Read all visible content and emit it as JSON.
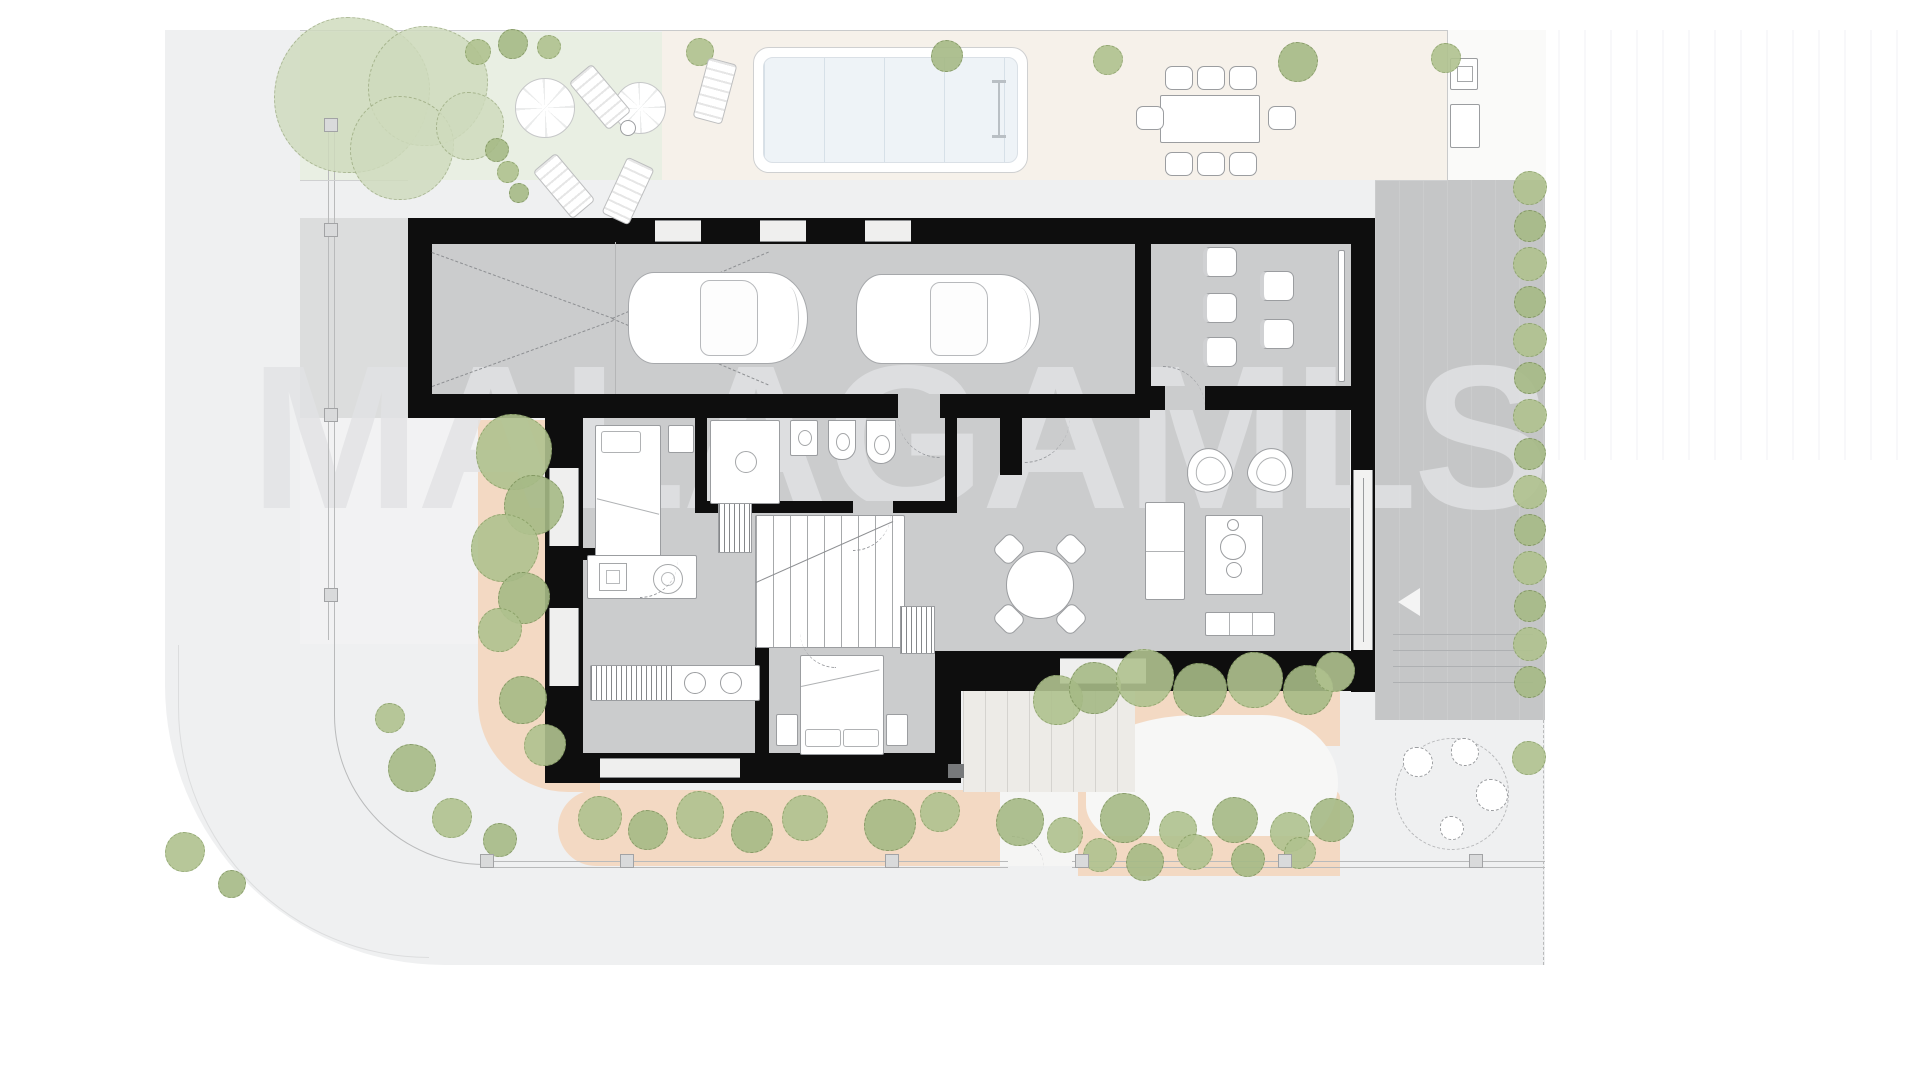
{
  "watermark": {
    "text": "MALAGAMLS"
  },
  "palette": {
    "background": "#ffffff",
    "street": "#eff0f1",
    "garden_green": "#e9efe3",
    "terrace_beige": "#f6f1ea",
    "planting_bed_orange": "#f3d9c3",
    "building_floor": "#cbcccd",
    "driveway": "#c5c6c7",
    "wall_black": "#0e0e0e",
    "tree_green": "#b0c28f",
    "pool_water": "#eef3f7",
    "watermark_gray": "#e2e3e5"
  },
  "scene": {
    "trees_big": [
      {
        "x": 352,
        "y": 95,
        "r": 78
      },
      {
        "x": 428,
        "y": 86,
        "r": 60
      },
      {
        "x": 402,
        "y": 148,
        "r": 52
      },
      {
        "x": 470,
        "y": 126,
        "r": 34
      }
    ],
    "tree_groups": {
      "top_bushes": [
        {
          "x": 478,
          "y": 52,
          "r": 13
        },
        {
          "x": 513,
          "y": 44,
          "r": 15
        },
        {
          "x": 549,
          "y": 47,
          "r": 12
        },
        {
          "x": 497,
          "y": 150,
          "r": 12
        },
        {
          "x": 508,
          "y": 172,
          "r": 11
        },
        {
          "x": 519,
          "y": 193,
          "r": 10
        }
      ],
      "terrace_trees": [
        {
          "x": 700,
          "y": 52,
          "r": 14
        },
        {
          "x": 947,
          "y": 56,
          "r": 16
        },
        {
          "x": 1108,
          "y": 60,
          "r": 15
        },
        {
          "x": 1298,
          "y": 62,
          "r": 20
        },
        {
          "x": 1446,
          "y": 58,
          "r": 15
        }
      ],
      "left_bed": [
        {
          "x": 514,
          "y": 452,
          "r": 38
        },
        {
          "x": 534,
          "y": 505,
          "r": 30
        },
        {
          "x": 505,
          "y": 548,
          "r": 34
        },
        {
          "x": 524,
          "y": 598,
          "r": 26
        },
        {
          "x": 500,
          "y": 630,
          "r": 22
        },
        {
          "x": 523,
          "y": 700,
          "r": 24
        },
        {
          "x": 545,
          "y": 745,
          "r": 21
        }
      ],
      "bottom_bed": [
        {
          "x": 600,
          "y": 818,
          "r": 22
        },
        {
          "x": 648,
          "y": 830,
          "r": 20
        },
        {
          "x": 700,
          "y": 815,
          "r": 24
        },
        {
          "x": 752,
          "y": 832,
          "r": 21
        },
        {
          "x": 805,
          "y": 818,
          "r": 23
        },
        {
          "x": 890,
          "y": 825,
          "r": 26
        },
        {
          "x": 940,
          "y": 812,
          "r": 20
        },
        {
          "x": 1020,
          "y": 822,
          "r": 24
        },
        {
          "x": 1065,
          "y": 835,
          "r": 18
        },
        {
          "x": 1125,
          "y": 818,
          "r": 25
        },
        {
          "x": 1178,
          "y": 830,
          "r": 19
        },
        {
          "x": 1235,
          "y": 820,
          "r": 23
        },
        {
          "x": 1290,
          "y": 832,
          "r": 20
        },
        {
          "x": 1332,
          "y": 820,
          "r": 22
        }
      ],
      "bottom_left_scatter": [
        {
          "x": 390,
          "y": 718,
          "r": 15
        },
        {
          "x": 412,
          "y": 768,
          "r": 24
        },
        {
          "x": 452,
          "y": 818,
          "r": 20
        },
        {
          "x": 500,
          "y": 840,
          "r": 17
        },
        {
          "x": 185,
          "y": 852,
          "r": 20
        },
        {
          "x": 232,
          "y": 884,
          "r": 14
        }
      ],
      "garden_right_upper": [
        {
          "x": 1058,
          "y": 700,
          "r": 25
        },
        {
          "x": 1095,
          "y": 688,
          "r": 26
        },
        {
          "x": 1145,
          "y": 678,
          "r": 29
        },
        {
          "x": 1200,
          "y": 690,
          "r": 27
        },
        {
          "x": 1255,
          "y": 680,
          "r": 28
        },
        {
          "x": 1308,
          "y": 690,
          "r": 25
        },
        {
          "x": 1335,
          "y": 672,
          "r": 20
        }
      ],
      "garden_right_lower": [
        {
          "x": 1100,
          "y": 855,
          "r": 17
        },
        {
          "x": 1145,
          "y": 862,
          "r": 19
        },
        {
          "x": 1195,
          "y": 852,
          "r": 18
        },
        {
          "x": 1248,
          "y": 860,
          "r": 17
        },
        {
          "x": 1300,
          "y": 853,
          "r": 16
        }
      ],
      "misc_right": [
        {
          "x": 1529,
          "y": 758,
          "r": 17
        }
      ]
    },
    "hedge_right": {
      "x": 1530,
      "y_start": 188,
      "step": 38,
      "count": 14,
      "r": 17
    },
    "fence_posts_left": {
      "x": 331,
      "ys": [
        125,
        230,
        415,
        595
      ]
    },
    "fence_posts_bottom": {
      "y": 861,
      "xs": [
        487,
        627,
        892,
        1082,
        1285,
        1476
      ]
    },
    "office_chairs": [
      {
        "x": 1203,
        "y": 247
      },
      {
        "x": 1203,
        "y": 293
      },
      {
        "x": 1203,
        "y": 337
      },
      {
        "x": 1260,
        "y": 271
      },
      {
        "x": 1260,
        "y": 319
      }
    ],
    "dining_chairs": [
      {
        "x": 1165,
        "y": 66
      },
      {
        "x": 1197,
        "y": 66
      },
      {
        "x": 1229,
        "y": 66
      },
      {
        "x": 1165,
        "y": 152
      },
      {
        "x": 1197,
        "y": 152
      },
      {
        "x": 1229,
        "y": 152
      },
      {
        "x": 1136,
        "y": 106
      },
      {
        "x": 1268,
        "y": 106
      }
    ],
    "loungers": [
      {
        "x": 585,
        "y": 66,
        "rot": -40
      },
      {
        "x": 549,
        "y": 155,
        "rot": -40
      },
      {
        "x": 613,
        "y": 160,
        "rot": 25
      },
      {
        "x": 700,
        "y": 60,
        "rot": 15
      }
    ],
    "seating_chairs": [
      {
        "x": 1418,
        "y": 762,
        "r": 15
      },
      {
        "x": 1465,
        "y": 752,
        "r": 14
      },
      {
        "x": 1492,
        "y": 795,
        "r": 16
      },
      {
        "x": 1452,
        "y": 828,
        "r": 12
      }
    ]
  }
}
